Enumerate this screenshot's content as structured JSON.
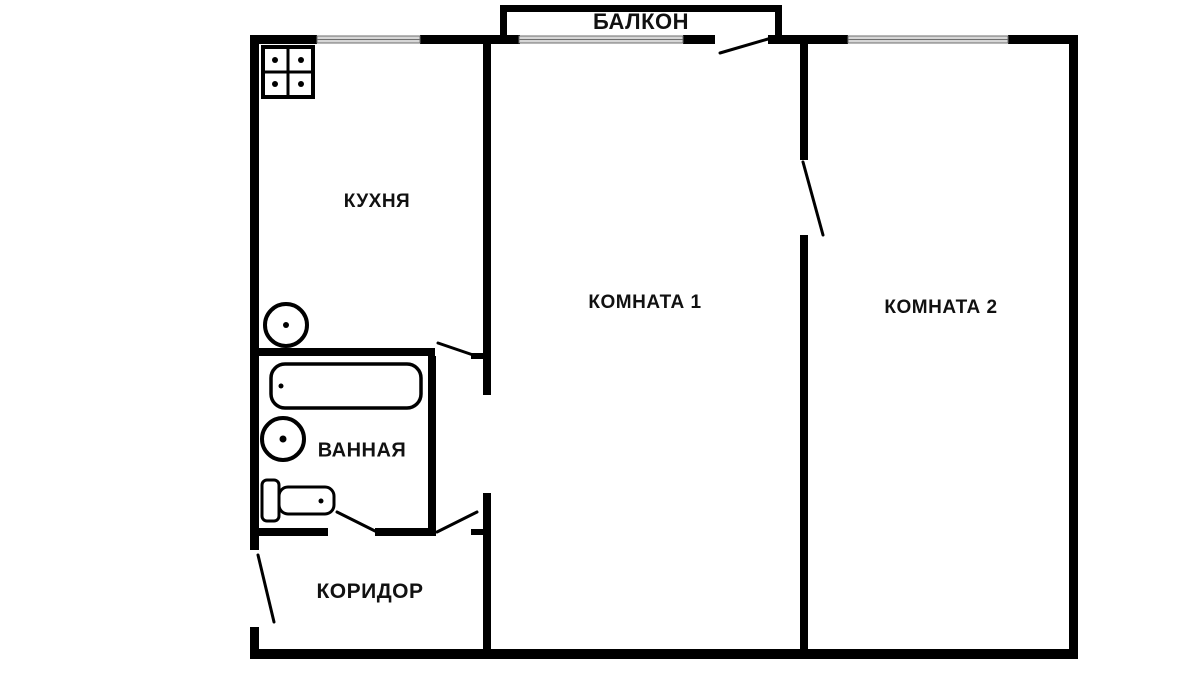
{
  "labels": {
    "balcony": "БАЛКОН",
    "kitchen": "КУХНЯ",
    "room1": "КОМНАТА 1",
    "room2": "КОМНАТА 2",
    "bathroom": "ВАННАЯ",
    "corridor": "КОРИДОР"
  },
  "plan": {
    "colors": {
      "wall": "#000000",
      "window_fill": "#d6d6d6",
      "window_edge": "#6e6e6e",
      "background": "#ffffff"
    },
    "walls": [
      {
        "name": "top-wall-kitchen-left",
        "x": 250,
        "y": 35,
        "w": 67,
        "h": 9
      },
      {
        "name": "top-wall-kitchen-right",
        "x": 420,
        "y": 35,
        "w": 100,
        "h": 9
      },
      {
        "name": "top-wall-room1-right",
        "x": 683,
        "y": 35,
        "w": 32,
        "h": 9
      },
      {
        "name": "top-wall-between-balcony-room2",
        "x": 768,
        "y": 35,
        "w": 80,
        "h": 9
      },
      {
        "name": "top-wall-room2-right",
        "x": 1008,
        "y": 35,
        "w": 70,
        "h": 9
      },
      {
        "name": "left-wall-upper",
        "x": 250,
        "y": 35,
        "w": 9,
        "h": 515
      },
      {
        "name": "left-wall-lower",
        "x": 250,
        "y": 627,
        "w": 9,
        "h": 32
      },
      {
        "name": "right-wall",
        "x": 1069,
        "y": 35,
        "w": 9,
        "h": 624
      },
      {
        "name": "bottom-wall",
        "x": 250,
        "y": 649,
        "w": 828,
        "h": 10
      },
      {
        "name": "balcony-left-wall",
        "x": 500,
        "y": 5,
        "w": 7,
        "h": 31
      },
      {
        "name": "balcony-top-wall",
        "x": 500,
        "y": 5,
        "w": 282,
        "h": 7
      },
      {
        "name": "balcony-right-wall",
        "x": 775,
        "y": 5,
        "w": 7,
        "h": 31
      },
      {
        "name": "kitchen-room1-wall-upper",
        "x": 483,
        "y": 44,
        "w": 8,
        "h": 351
      },
      {
        "name": "kitchen-room1-wall-lower",
        "x": 483,
        "y": 493,
        "w": 8,
        "h": 156
      },
      {
        "name": "room1-room2-wall-upper",
        "x": 800,
        "y": 44,
        "w": 8,
        "h": 116
      },
      {
        "name": "room1-room2-wall-lower",
        "x": 800,
        "y": 235,
        "w": 8,
        "h": 414
      },
      {
        "name": "kitchen-bathroom-wall",
        "x": 259,
        "y": 348,
        "w": 176,
        "h": 8
      },
      {
        "name": "bathroom-corridor-wall-left",
        "x": 259,
        "y": 528,
        "w": 69,
        "h": 8
      },
      {
        "name": "bathroom-corridor-wall-right",
        "x": 375,
        "y": 528,
        "w": 61,
        "h": 8
      },
      {
        "name": "bathroom-right-wall",
        "x": 428,
        "y": 356,
        "w": 8,
        "h": 180
      },
      {
        "name": "kitchen-door-jamb-tick",
        "x": 471,
        "y": 353,
        "w": 12,
        "h": 6
      },
      {
        "name": "corridor-door-jamb-tick",
        "x": 471,
        "y": 529,
        "w": 12,
        "h": 6
      }
    ],
    "windows": [
      {
        "name": "kitchen-window",
        "x": 317,
        "y": 36,
        "w": 103,
        "h": 7
      },
      {
        "name": "room1-balcony-window",
        "x": 519,
        "y": 36,
        "w": 164,
        "h": 7
      },
      {
        "name": "room2-window",
        "x": 848,
        "y": 36,
        "w": 160,
        "h": 7
      }
    ],
    "door_swings": [
      {
        "name": "balcony-door-swing",
        "x1": 720,
        "y1": 53,
        "x2": 768,
        "y2": 39
      },
      {
        "name": "room1-room2-door-swing",
        "x1": 803,
        "y1": 162,
        "x2": 823,
        "y2": 235
      },
      {
        "name": "kitchen-door-swing",
        "x1": 438,
        "y1": 343,
        "x2": 479,
        "y2": 357
      },
      {
        "name": "bathroom-door-swing",
        "x1": 337,
        "y1": 512,
        "x2": 375,
        "y2": 531
      },
      {
        "name": "corridor-door-swing",
        "x1": 437,
        "y1": 532,
        "x2": 477,
        "y2": 512
      },
      {
        "name": "entrance-door-swing",
        "x1": 258,
        "y1": 555,
        "x2": 274,
        "y2": 622
      }
    ],
    "fixtures": [
      {
        "name": "stove-icon",
        "type": "grid-box",
        "x": 263,
        "y": 47,
        "w": 50,
        "h": 50,
        "stroke": 4,
        "dots": [
          [
            275,
            60
          ],
          [
            301,
            60
          ],
          [
            275,
            84
          ],
          [
            301,
            84
          ]
        ],
        "dot_r": 3
      },
      {
        "name": "kitchen-sink-icon",
        "type": "circle",
        "cx": 286,
        "cy": 325,
        "r": 21,
        "stroke": 4,
        "dot_r": 3
      },
      {
        "name": "bathtub-icon",
        "type": "round-rect",
        "x": 271,
        "y": 364,
        "w": 150,
        "h": 44,
        "rx": 14,
        "stroke": 3.5,
        "dot": [
          281,
          386
        ],
        "dot_r": 2.5
      },
      {
        "name": "bathroom-sink-icon",
        "type": "circle",
        "cx": 283,
        "cy": 439,
        "r": 21,
        "stroke": 4,
        "dot_r": 3.5
      },
      {
        "name": "toilet-tank-icon",
        "type": "round-rect",
        "x": 262,
        "y": 480,
        "w": 17,
        "h": 41,
        "rx": 5,
        "stroke": 3
      },
      {
        "name": "toilet-bowl-icon",
        "type": "round-rect",
        "x": 279,
        "y": 487,
        "w": 55,
        "h": 27,
        "rx": 9,
        "stroke": 3,
        "dot": [
          321,
          501
        ],
        "dot_r": 2.5
      }
    ]
  }
}
